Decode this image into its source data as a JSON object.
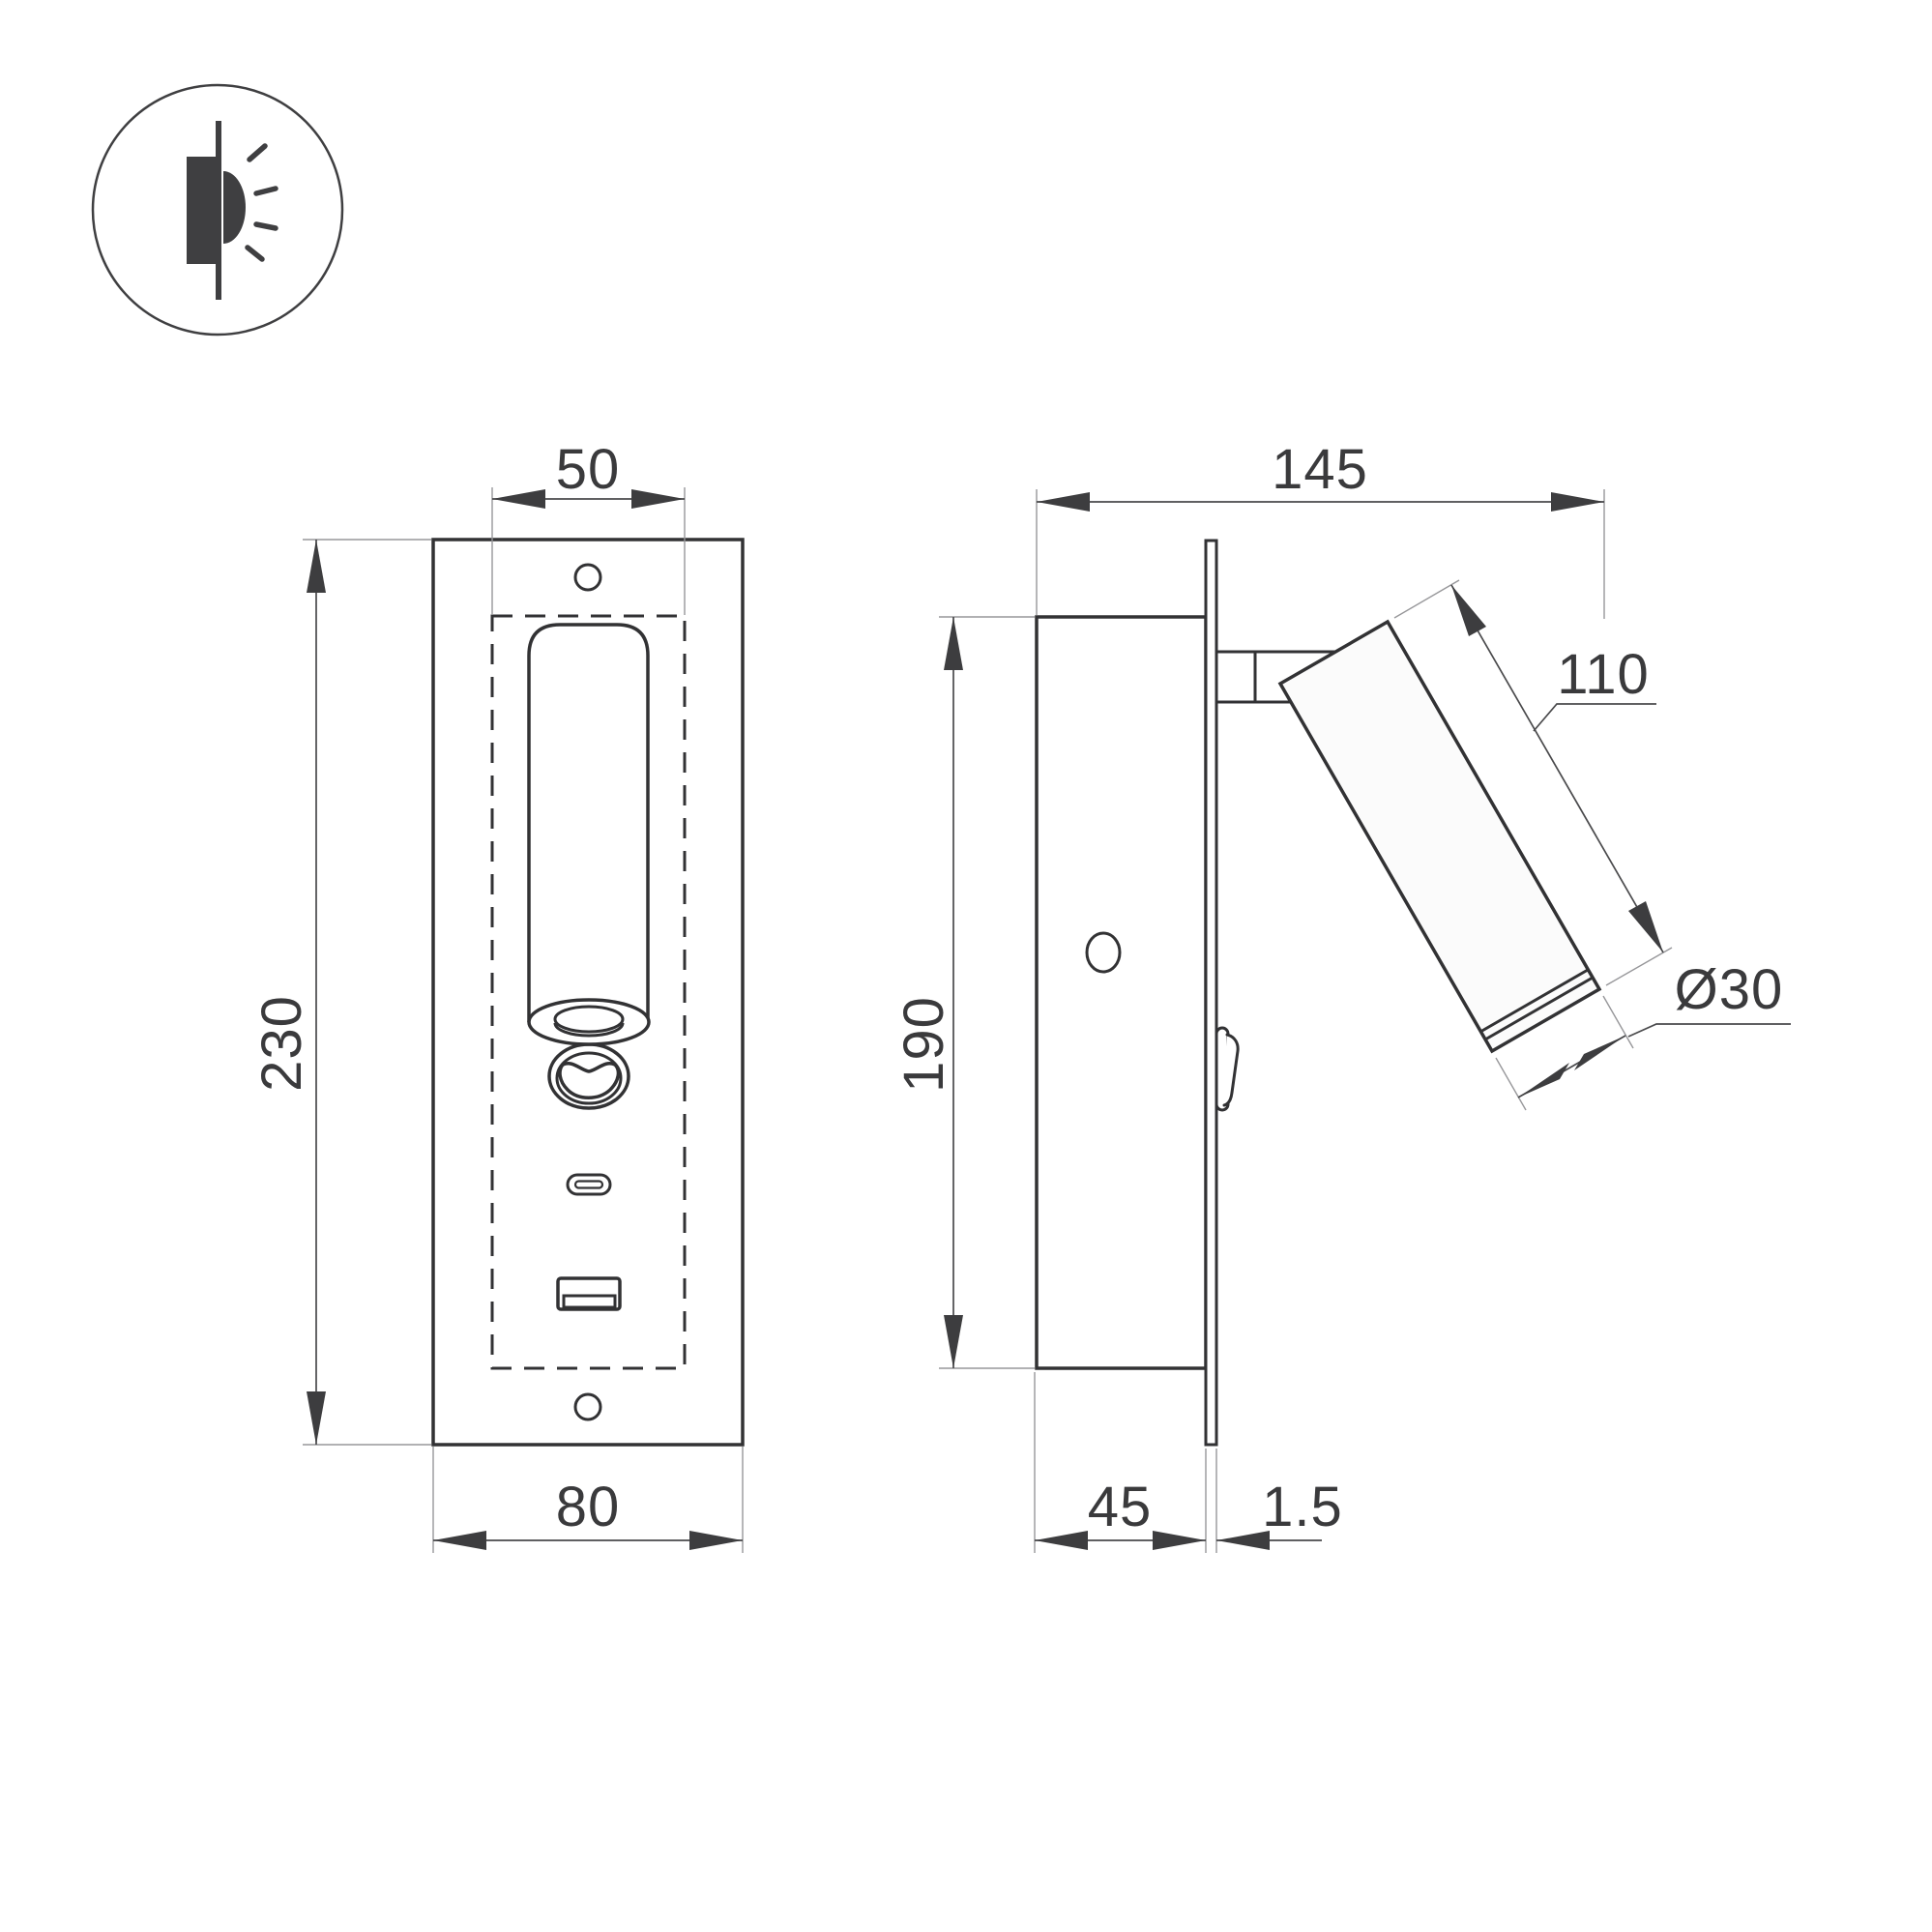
{
  "drawing": {
    "type": "technical-dimension-drawing",
    "product": "recessed wall reading light with USB charging",
    "units": "mm",
    "line_color": "#323234",
    "dim_color": "#3a3a3c",
    "background": "#ffffff"
  },
  "icon": {
    "name": "recessed-wall-light-emitting-icon"
  },
  "front_view": {
    "dim_cutout_width": "50",
    "dim_height": "230",
    "dim_width": "80"
  },
  "side_view": {
    "dim_total_depth": "145",
    "dim_body_height": "190",
    "dim_spot_length": "110",
    "dim_spot_diameter": "Ø30",
    "dim_recess_depth": "45",
    "dim_plate_thickness": "1.5"
  }
}
